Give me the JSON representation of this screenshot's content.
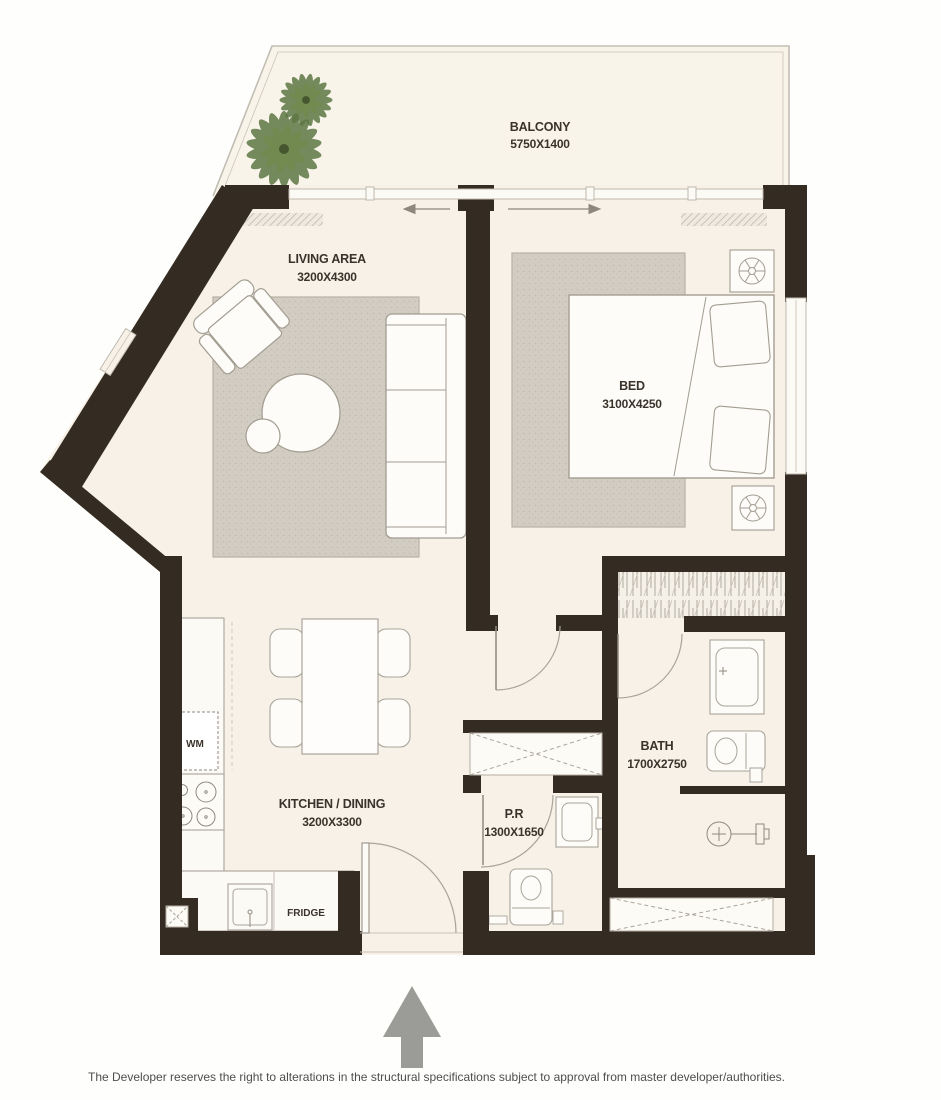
{
  "rooms": {
    "balcony": {
      "name": "BALCONY",
      "dims": "5750X1400"
    },
    "living": {
      "name": "LIVING AREA",
      "dims": "3200X4300"
    },
    "bed": {
      "name": "BED",
      "dims": "3100X4250"
    },
    "kitchen": {
      "name": "KITCHEN / DINING",
      "dims": "3200X3300"
    },
    "bath": {
      "name": "BATH",
      "dims": "1700X2750"
    },
    "pr": {
      "name": "P.R",
      "dims": "1300X1650"
    }
  },
  "appliances": {
    "wm": "WM",
    "fridge": "FRIDGE"
  },
  "icons": {
    "tree": "palm-tree-icon",
    "entry_arrow": "entry-arrow-icon",
    "lamp": "lamp-icon",
    "shower": "shower-icon"
  },
  "footer": {
    "disclaimer": "The Developer reserves the right to alterations in the structural specifications subject to approval from master developer/authorities."
  },
  "colors": {
    "wall": "#342c23",
    "floor": "#f7f1e7",
    "balcony_floor": "#f9f4ea",
    "rug": "#d2cdc3",
    "tree": "#5d7744",
    "arrow": "#9b9b98",
    "label_text": "#3a332b"
  }
}
